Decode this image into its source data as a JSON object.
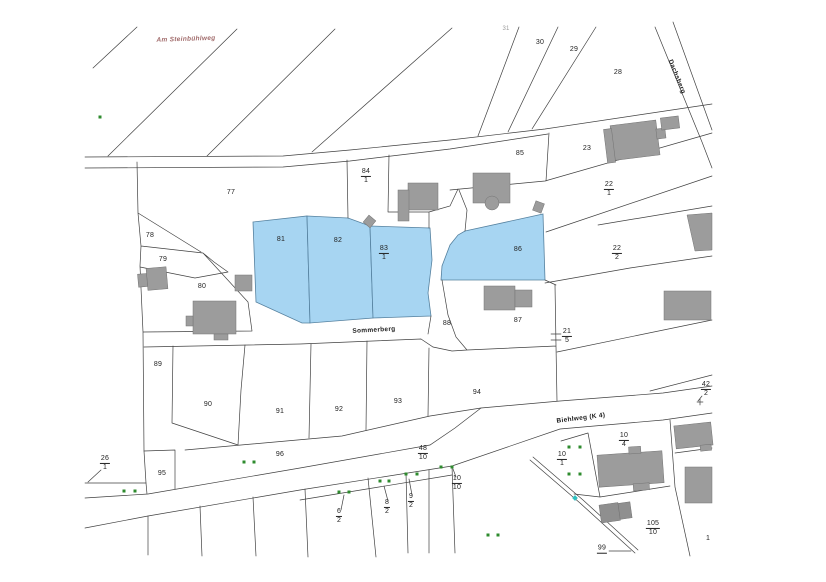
{
  "map": {
    "type": "cadastral-parcel-map",
    "highlighted_parcels": [
      "81",
      "82",
      "83/1",
      "86"
    ]
  },
  "colors": {
    "highlight": "#a7d5f2",
    "highlight_border": "#55819f",
    "line": "#404040",
    "label": "#222222",
    "building": "#9c9c9c",
    "building_dark": "#8f8f8f",
    "tree": "#2e8b2e",
    "teal": "#2fc0c0",
    "street_red": "#a06a6a"
  },
  "street_labels": [
    {
      "t": "Am Steinbühlweg",
      "x": 186,
      "y": 40,
      "rot": -2,
      "cls": "red"
    },
    {
      "t": "Sommerberg",
      "x": 374,
      "y": 331,
      "rot": -3,
      "cls": ""
    },
    {
      "t": "Biehlweg (K 4)",
      "x": 581,
      "y": 419,
      "rot": -7,
      "cls": ""
    },
    {
      "t": "Dachsberg",
      "x": 676,
      "y": 77,
      "rot": 68,
      "cls": ""
    }
  ],
  "parcel_labels": [
    {
      "t": "31",
      "x": 506,
      "y": 29,
      "cls": "faint"
    },
    {
      "t": "30",
      "x": 540,
      "y": 43
    },
    {
      "t": "29",
      "x": 574,
      "y": 50
    },
    {
      "t": "28",
      "x": 618,
      "y": 73
    },
    {
      "t": "23",
      "x": 587,
      "y": 149
    },
    {
      "t": "85",
      "x": 520,
      "y": 154
    },
    {
      "n": "84",
      "d": "1",
      "x": 366,
      "y": 176
    },
    {
      "t": "77",
      "x": 231,
      "y": 193
    },
    {
      "n": "22",
      "d": "1",
      "x": 609,
      "y": 189
    },
    {
      "t": "78",
      "x": 150,
      "y": 236
    },
    {
      "t": "81",
      "x": 281,
      "y": 240
    },
    {
      "t": "82",
      "x": 338,
      "y": 241
    },
    {
      "n": "83",
      "d": "1",
      "x": 384,
      "y": 253
    },
    {
      "t": "86",
      "x": 518,
      "y": 250
    },
    {
      "n": "22",
      "d": "2",
      "x": 617,
      "y": 253
    },
    {
      "t": "79",
      "x": 163,
      "y": 260
    },
    {
      "t": "80",
      "x": 202,
      "y": 287
    },
    {
      "t": "88",
      "x": 447,
      "y": 324
    },
    {
      "t": "87",
      "x": 518,
      "y": 321
    },
    {
      "n": "21",
      "d": "5",
      "x": 567,
      "y": 336
    },
    {
      "t": "89",
      "x": 158,
      "y": 365
    },
    {
      "n": "42",
      "d": "2",
      "x": 706,
      "y": 389
    },
    {
      "t": "90",
      "x": 208,
      "y": 405
    },
    {
      "t": "91",
      "x": 280,
      "y": 412
    },
    {
      "t": "92",
      "x": 339,
      "y": 410
    },
    {
      "t": "93",
      "x": 398,
      "y": 402
    },
    {
      "t": "94",
      "x": 477,
      "y": 393
    },
    {
      "t": "96",
      "x": 280,
      "y": 455
    },
    {
      "t": "95",
      "x": 162,
      "y": 474
    },
    {
      "n": "26",
      "d": "1",
      "x": 105,
      "y": 463
    },
    {
      "n": "48",
      "d": "10",
      "x": 423,
      "y": 453
    },
    {
      "n": "10",
      "d": "4",
      "x": 624,
      "y": 440
    },
    {
      "n": "10",
      "d": "1",
      "x": 562,
      "y": 459
    },
    {
      "n": "10",
      "d": "10",
      "x": 457,
      "y": 483
    },
    {
      "n": "6",
      "d": "2",
      "x": 339,
      "y": 516
    },
    {
      "n": "8",
      "d": "2",
      "x": 387,
      "y": 507
    },
    {
      "n": "9",
      "d": "2",
      "x": 411,
      "y": 501
    },
    {
      "n": "105",
      "d": "10",
      "x": 653,
      "y": 528
    },
    {
      "n": "99",
      "x": 602,
      "y": 549
    },
    {
      "t": "1",
      "x": 708,
      "y": 539
    }
  ],
  "tree_markers": [
    [
      100,
      117
    ],
    [
      124,
      491
    ],
    [
      135,
      491
    ],
    [
      244,
      462
    ],
    [
      254,
      462
    ],
    [
      339,
      492
    ],
    [
      349,
      492
    ],
    [
      380,
      481
    ],
    [
      389,
      481
    ],
    [
      406,
      474
    ],
    [
      417,
      474
    ],
    [
      441,
      467
    ],
    [
      452,
      467
    ],
    [
      488,
      535
    ],
    [
      498,
      535
    ],
    [
      569,
      447
    ],
    [
      580,
      447
    ],
    [
      569,
      474
    ],
    [
      580,
      474
    ]
  ],
  "teal_marker": [
    575,
    498
  ]
}
